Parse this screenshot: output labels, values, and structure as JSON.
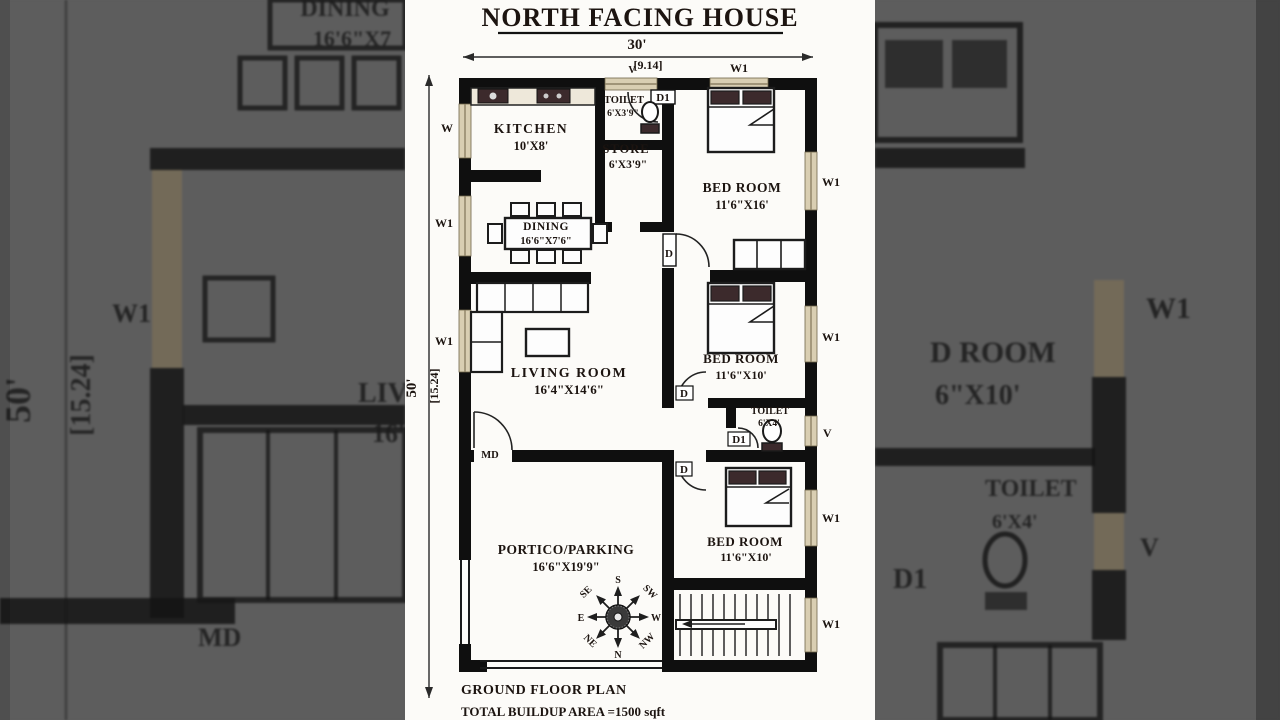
{
  "title": "NORTH FACING HOUSE",
  "dimensions": {
    "width_ft": "30'",
    "width_m": "[9.14]",
    "depth_ft": "50'",
    "depth_m": "[15.24]"
  },
  "rooms": {
    "kitchen": {
      "name": "KITCHEN",
      "size": "10'X8'"
    },
    "toilet_top": {
      "name": "TOILET",
      "size": "6'X3'9\""
    },
    "store": {
      "name": "STORE",
      "size": "6'X3'9\""
    },
    "bedroom_top": {
      "name": "BED ROOM",
      "size": "11'6\"X16'"
    },
    "dining": {
      "name": "DINING",
      "size": "16'6\"X7'6\""
    },
    "living": {
      "name": "LIVING ROOM",
      "size": "16'4\"X14'6\""
    },
    "bedroom_mid": {
      "name": "BED ROOM",
      "size": "11'6\"X10'"
    },
    "toilet_mid": {
      "name": "TOILET",
      "size": "6'X4'"
    },
    "bedroom_bottom": {
      "name": "BED ROOM",
      "size": "11'6\"X10'"
    },
    "portico": {
      "name": "PORTICO/PARKING",
      "size": "16'6\"X19'9\""
    }
  },
  "tags": {
    "window_w1": "W1",
    "window_w": "W",
    "vent": "V",
    "door": "D",
    "door_d1": "D1",
    "main_door": "MD"
  },
  "compass": {
    "n": "N",
    "s": "S",
    "e": "E",
    "w": "W",
    "ne": "NE",
    "nw": "NW",
    "se": "SE",
    "sw": "SW"
  },
  "footer": {
    "plan_name": "GROUND FLOOR PLAN",
    "area": "TOTAL BUILDUP AREA =1500 sqft"
  },
  "background": {
    "left": {
      "depth_ft": "50'",
      "depth_m": "[15.24]",
      "window": "W1",
      "dining_partial": "DINING",
      "dining_size_partial": "16'6\"X7",
      "living_partial": "LIVI",
      "living_size_partial": "16'",
      "main_door": "MD"
    },
    "right": {
      "window": "W1",
      "bedroom_partial": "D ROOM",
      "bedroom_size_partial": "6\"X10'",
      "toilet": "TOILET",
      "toilet_size": "6'X4'",
      "vent": "V",
      "door": "D1"
    }
  },
  "colors": {
    "backdrop": "#5d5d5d",
    "paper": "#fcfbf8",
    "wall": "#0f0f0f",
    "window_fill": "#d9ceb2",
    "furniture_dark": "#3c2a2c",
    "text": "#1c1410"
  }
}
